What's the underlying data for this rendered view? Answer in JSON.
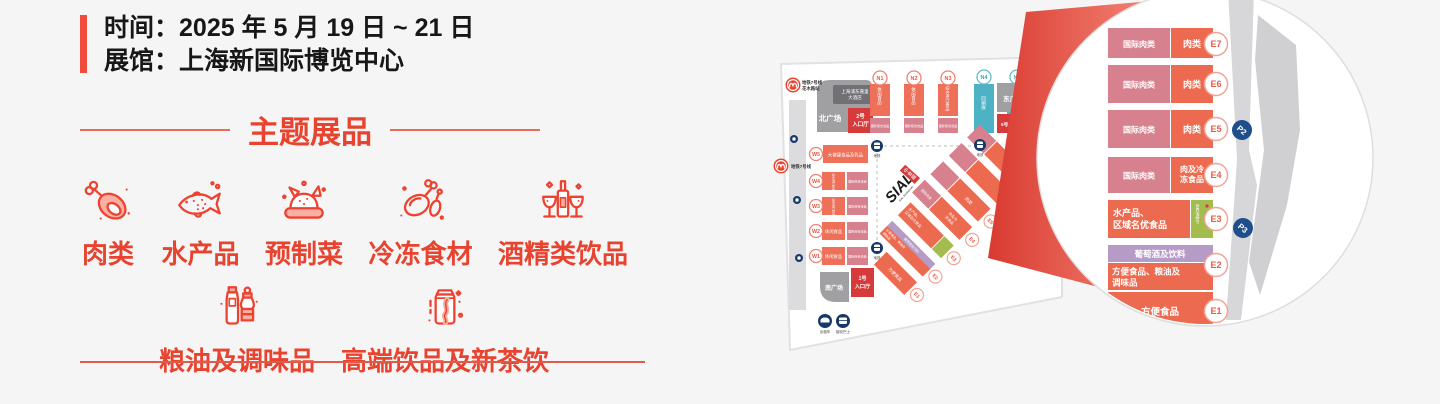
{
  "info": {
    "time_label": "时间：",
    "time_value": "2025 年 5 月 19 日 ~ 21 日",
    "venue_label": "展馆：",
    "venue_value": "上海新国际博览中心"
  },
  "section_title": "主题展品",
  "categories_row1": [
    {
      "label": "肉类",
      "icon": "meat-icon"
    },
    {
      "label": "水产品",
      "icon": "fish-icon"
    },
    {
      "label": "预制菜",
      "icon": "prepared-dish-icon"
    },
    {
      "label": "冷冻食材",
      "icon": "frozen-food-icon"
    },
    {
      "label": "酒精类饮品",
      "icon": "alcohol-icon"
    }
  ],
  "categories_row2": [
    {
      "label": "粮油及调味品",
      "icon": "condiment-icon"
    },
    {
      "label": "高端饮品及新茶饮",
      "icon": "beverage-icon"
    }
  ],
  "map": {
    "metro_top": {
      "line1": "地铁7号线",
      "line2": "花木路站"
    },
    "metro_left": "地铁7号线",
    "hotel": {
      "line1": "上海浦东嘉里",
      "line2": "大酒店"
    },
    "plaza_north": "北广场",
    "plaza_east": "东广场",
    "plaza_south": "南广场",
    "entrance2": {
      "line1": "2号",
      "line2": "入口厅"
    },
    "entrance5": "5号入口厅",
    "entrance1": {
      "line1": "1号",
      "line2": "入口厅"
    },
    "metro_station_label": "地铁",
    "n_halls": [
      {
        "id": "N1",
        "cat": "休闲食品",
        "sub": "国际综合食品"
      },
      {
        "id": "N2",
        "cat": "休闲食品",
        "sub": "国际综合食品"
      },
      {
        "id": "N3",
        "cat": "综合进口食品",
        "sub": "国际综合食品"
      },
      {
        "id": "N4",
        "cat": "同期展"
      },
      {
        "id": "N5",
        "cat": "同期展"
      }
    ],
    "w_halls": [
      {
        "id": "W5",
        "cat": "大健康食品及乳品"
      },
      {
        "id": "W4",
        "cat": "综合进口食品",
        "sub": "国际综合食品"
      },
      {
        "id": "W3",
        "cat": "综合进口食品",
        "sub": "国际综合食品"
      },
      {
        "id": "W2",
        "cat": "休闲食品",
        "sub": "国际综合食品"
      },
      {
        "id": "W1",
        "cat": "休闲食品",
        "sub": "国际综合食品"
      }
    ],
    "e_halls": [
      {
        "id": "E7",
        "intl": "国际肉类",
        "cat": "肉类"
      },
      {
        "id": "E6",
        "intl": "国际肉类",
        "cat": "肉类"
      },
      {
        "id": "E5",
        "intl": "国际肉类",
        "cat": "肉类"
      },
      {
        "id": "E4",
        "intl": "国际肉类",
        "cat1": "肉及冷",
        "cat2": "冻食品"
      },
      {
        "id": "E3",
        "cat1": "水产品、",
        "cat2": "区域名优食品",
        "side": "世界海鲜节"
      },
      {
        "id": "E2",
        "top": "葡萄酒及饮料",
        "cat1": "方便食品、粮油及",
        "cat2": "调味品"
      },
      {
        "id": "E1",
        "cat": "方便食品"
      }
    ],
    "sial": {
      "logo": "SIAL",
      "tagline": "SIAL SHANGHAI",
      "cn": "中食展"
    },
    "parking": {
      "p2": "P2",
      "p3": "P3"
    },
    "transport": {
      "taxi": "出租车",
      "shuttle": "接驳巴士"
    }
  },
  "colors": {
    "accent_red": "#e8432e",
    "hall_orange": "#ec6a50",
    "hall_pink": "#d8818e",
    "hall_teal": "#4db2c4",
    "hall_purple": "#b69bc7",
    "hall_green": "#a4bc4e",
    "entrance_red": "#d63a3a",
    "navy": "#17386b"
  }
}
